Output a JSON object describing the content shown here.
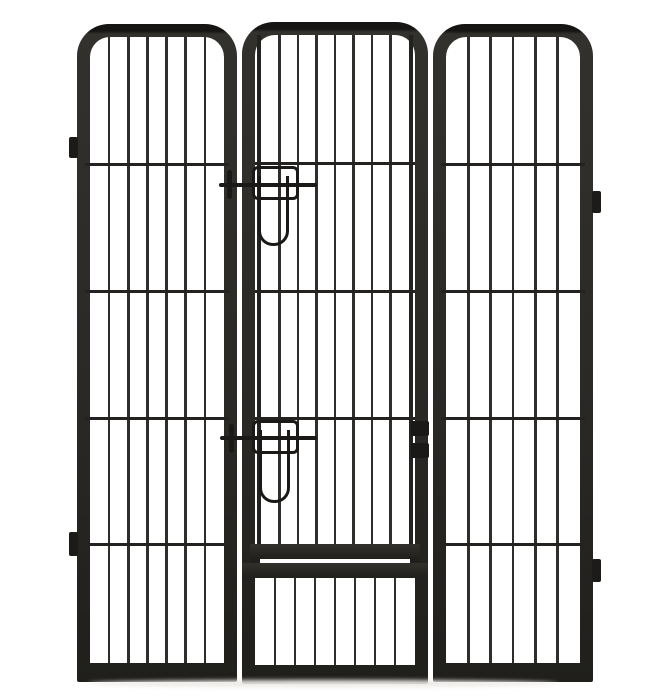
{
  "image": {
    "width": 648,
    "height": 698,
    "alt": "Product photo of a heavy-duty black metal pet playpen: three vertical-bar panels with rounded tops, the center panel containing a hinged walk-through door secured by two slide-bolt latches with U-shaped handles, connector tabs on the outer edges"
  },
  "colors": {
    "background": "#ffffff",
    "frame_cap": "#161513",
    "frame_top": "#33312d",
    "frame_mid": "#2b2926",
    "frame_dark": "#201f1c",
    "bar": "#302e2b",
    "crossbar": "#232220",
    "hardware": "#1a1918",
    "tab": "#1c1b19",
    "shadow": "#eceae7"
  },
  "panels": [
    {
      "id": "panel-left",
      "type": "side",
      "x": 77,
      "y": 24,
      "w": 160,
      "h": 658,
      "frame": 13,
      "rail": 19,
      "bar_count": 6,
      "crossbars": [
        139,
        266,
        393,
        519
      ]
    },
    {
      "id": "panel-middle",
      "type": "door",
      "x": 242,
      "y": 22,
      "w": 186,
      "h": 662,
      "frame": 13,
      "rail": 19,
      "door": {
        "post_x": [
          15,
          167
        ],
        "post_w": 4,
        "post_y1": 13,
        "post_y2": 526,
        "bar_count": 7,
        "bars_x1": 19,
        "bars_x2": 167,
        "bars_y1": 13,
        "bars_y2": 522,
        "crossbars": [
          140,
          268,
          395
        ],
        "cross_x1": 13,
        "cross_x2": 173,
        "bottom_frame": {
          "x": 8,
          "y": 522,
          "w": 170,
          "h": 15
        },
        "feet": [
          {
            "x": 8,
            "y": 537,
            "w": 10,
            "h": 7
          },
          {
            "x": 168,
            "y": 537,
            "w": 10,
            "h": 7
          }
        ],
        "cross_rail": {
          "y": 541,
          "h": 15
        },
        "bottom_bars": {
          "count": 7,
          "x1": 13,
          "x2": 173,
          "y1": 556,
          "y2": 643
        }
      }
    },
    {
      "id": "panel-right",
      "type": "side",
      "x": 433,
      "y": 24,
      "w": 160,
      "h": 658,
      "frame": 13,
      "rail": 19,
      "bar_count": 5,
      "crossbars": [
        139,
        266,
        393,
        519
      ]
    }
  ],
  "latches": [
    {
      "id": "latch-upper",
      "bar": {
        "x": 219,
        "y": 183,
        "w": 98,
        "h": 4
      },
      "pin": {
        "x": 227,
        "y": 170,
        "w": 5,
        "h": 29
      },
      "bracket": {
        "x": 252,
        "y": 166,
        "w": 47,
        "h": 34
      },
      "handle": {
        "x": 258,
        "y": 176,
        "w": 31,
        "h": 70
      }
    },
    {
      "id": "latch-lower",
      "bar": {
        "x": 220,
        "y": 436,
        "w": 97,
        "h": 4
      },
      "pin": {
        "x": 229,
        "y": 424,
        "w": 5,
        "h": 29
      },
      "bracket": {
        "x": 252,
        "y": 420,
        "w": 47,
        "h": 34
      },
      "handle": {
        "x": 259,
        "y": 430,
        "w": 31,
        "h": 73
      }
    }
  ],
  "hinges": [
    {
      "x": 411,
      "y": 421,
      "w": 18,
      "h": 15
    },
    {
      "x": 411,
      "y": 443,
      "w": 18,
      "h": 15
    }
  ],
  "tabs": [
    {
      "x": 69,
      "y": 137,
      "w": 9,
      "h": 21
    },
    {
      "x": 69,
      "y": 532,
      "w": 9,
      "h": 24
    },
    {
      "x": 592,
      "y": 191,
      "w": 9,
      "h": 22
    },
    {
      "x": 592,
      "y": 559,
      "w": 9,
      "h": 23
    }
  ],
  "ground_shadow": {
    "x": 88,
    "y": 680,
    "w": 470,
    "h": 7
  }
}
